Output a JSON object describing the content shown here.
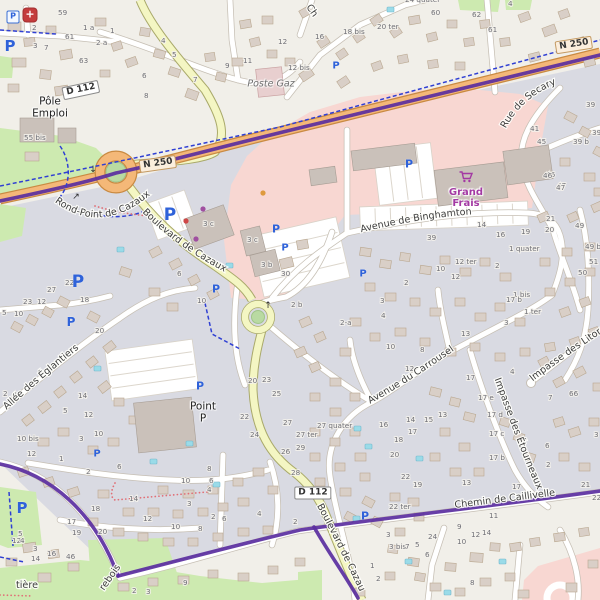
{
  "palette": {
    "land": "#f1efe9",
    "residential": "#d9dae2",
    "retail": "#f8d7d2",
    "green": "#cdeab0",
    "island_green": "#b9daa2",
    "island_stroke": "#a0c489",
    "building": "#d9cfc7",
    "building_stroke": "#b9a78f",
    "commercial": "#cac1ba",
    "commercial_stroke": "#a79d94",
    "pool": "#9adbe8",
    "pool_stroke": "#74b8cc",
    "road_minor": "#ffffff",
    "road_minor_casing": "#c6bfb4",
    "road_secondary": "#f4f6c3",
    "road_secondary_casing": "#a9a96a",
    "road_trunk": "#f4b878",
    "road_trunk_casing": "#c98a42",
    "route_bicycle": "#5a2ea0",
    "cycleway": "#2f3fd3",
    "footpath": "#e06f76",
    "parking_blue": "#2f62d9",
    "poi_purple": "#a339a3",
    "poste_building": "#e8cfcf"
  },
  "shields": [
    {
      "text": "D 112",
      "x": 81,
      "y": 90,
      "rot": -12,
      "cls": "d"
    },
    {
      "text": "N 250",
      "x": 158,
      "y": 164,
      "rot": -8,
      "cls": "n"
    },
    {
      "text": "N 250",
      "x": 574,
      "y": 45,
      "rot": -9,
      "cls": "n"
    },
    {
      "text": "D 112",
      "x": 313,
      "y": 493,
      "rot": 0,
      "cls": "d"
    }
  ],
  "street_labels": [
    {
      "id": "rond-point",
      "text": "Rond-Point de Cazaux",
      "mode": "path",
      "path": "tp-rond",
      "size": 9.3,
      "offset": "2%"
    },
    {
      "id": "bd-cazaux-upper",
      "text": "Boulevard de Cazaux",
      "mode": "path",
      "path": "tp-bd",
      "size": 9.8,
      "offset": "6%"
    },
    {
      "id": "binghamton",
      "text": "Avenue de Binghamton",
      "mode": "path",
      "path": "tp-bing",
      "size": 9.8,
      "offset": "4%"
    },
    {
      "id": "secary",
      "text": "Rue de Secary",
      "mode": "path",
      "path": "tp-sec",
      "size": 9.8,
      "offset": "2%"
    },
    {
      "id": "carrousel",
      "text": "Avenue du Carrousel",
      "mode": "path",
      "path": "tp-carr",
      "size": 9.8,
      "offset": "5%"
    },
    {
      "id": "etourneaux",
      "text": "Impasse des Étourneaux",
      "mode": "path",
      "path": "tp-etour",
      "size": 9.2,
      "offset": "1%"
    },
    {
      "id": "eglantiers",
      "text": "Allée des Églantiers",
      "mode": "path",
      "path": "tp-egl",
      "size": 9.8,
      "offset": "4%"
    },
    {
      "id": "litornes",
      "text": "Impasse des Litornes",
      "mode": "path",
      "path": "tp-lit",
      "size": 9.2,
      "offset": "1%"
    },
    {
      "id": "chemin-caillivelle",
      "text": "Chemin de Caillivelle",
      "mode": "path",
      "path": "tp-chem",
      "size": 9.2,
      "offset": "52%"
    },
    {
      "id": "bd-cazaux-lower",
      "text": "Boulevard de Cazaux",
      "mode": "path",
      "path": "tp-bdlow",
      "size": 9.2,
      "offset": "2%"
    },
    {
      "id": "fragment-ch",
      "text": "Ch",
      "mode": "rot",
      "x": 306,
      "y": 7,
      "rot": 55,
      "size": 9.5
    },
    {
      "id": "fragment-tiere",
      "text": "tière",
      "mode": "rot",
      "x": 16,
      "y": 588,
      "rot": 0,
      "size": 9.8
    },
    {
      "id": "fragment-rebois",
      "text": "rebois",
      "mode": "rot",
      "x": 104,
      "y": 591,
      "rot": -55,
      "size": 9.5
    }
  ],
  "places": {
    "pole_emploi": {
      "line1": "Pôle",
      "line2": "Emploi"
    },
    "poste_gaz": {
      "text": "Poste Gaz"
    },
    "point_p": {
      "line1": "Point",
      "line2": "P"
    },
    "grand_frais": {
      "line1": "Grand",
      "line2": "Frais"
    }
  },
  "icons": {
    "medical": "+",
    "parking_letter": "P"
  },
  "house_numbers": [
    [
      58,
      15,
      "59"
    ],
    [
      65,
      39,
      "61"
    ],
    [
      79,
      63,
      "63"
    ],
    [
      32,
      30,
      "2"
    ],
    [
      33,
      48,
      "3"
    ],
    [
      44,
      50,
      "7"
    ],
    [
      83,
      30,
      "1 a"
    ],
    [
      96,
      45,
      "2 a"
    ],
    [
      110,
      33,
      "1"
    ],
    [
      161,
      43,
      "4"
    ],
    [
      172,
      57,
      "5"
    ],
    [
      193,
      82,
      "7"
    ],
    [
      225,
      68,
      "9"
    ],
    [
      243,
      63,
      "11"
    ],
    [
      278,
      44,
      "12"
    ],
    [
      288,
      70,
      "12 bis"
    ],
    [
      142,
      78,
      "6"
    ],
    [
      144,
      98,
      "8"
    ],
    [
      24,
      140,
      "55 bis"
    ],
    [
      405,
      2,
      "24 quater"
    ],
    [
      431,
      15,
      "60"
    ],
    [
      472,
      17,
      "62"
    ],
    [
      488,
      32,
      "61"
    ],
    [
      377,
      29,
      "20 ter"
    ],
    [
      343,
      34,
      "18 bis"
    ],
    [
      315,
      39,
      "16"
    ],
    [
      508,
      6,
      "4"
    ],
    [
      586,
      107,
      "39"
    ],
    [
      530,
      131,
      "41"
    ],
    [
      537,
      144,
      "45"
    ],
    [
      573,
      144,
      "39 b"
    ],
    [
      592,
      135,
      "39 a"
    ],
    [
      546,
      177,
      "46"
    ],
    [
      557,
      188,
      "47"
    ],
    [
      203,
      226,
      "3 c"
    ],
    [
      247,
      242,
      "3 c"
    ],
    [
      261,
      267,
      "3 b"
    ],
    [
      281,
      276,
      "30"
    ],
    [
      291,
      307,
      "2 b"
    ],
    [
      177,
      276,
      "6"
    ],
    [
      197,
      303,
      "10"
    ],
    [
      65,
      285,
      "22"
    ],
    [
      47,
      292,
      "27"
    ],
    [
      23,
      304,
      "23"
    ],
    [
      37,
      304,
      "12"
    ],
    [
      80,
      302,
      "18"
    ],
    [
      2,
      315,
      "5"
    ],
    [
      14,
      316,
      "10"
    ],
    [
      95,
      333,
      "20"
    ],
    [
      78,
      398,
      "14"
    ],
    [
      63,
      413,
      "5"
    ],
    [
      84,
      417,
      "12"
    ],
    [
      94,
      436,
      "10"
    ],
    [
      79,
      441,
      "3"
    ],
    [
      17,
      441,
      "10 bis"
    ],
    [
      3,
      396,
      "2"
    ],
    [
      12,
      397,
      "4"
    ],
    [
      477,
      227,
      "14"
    ],
    [
      496,
      237,
      "16"
    ],
    [
      427,
      240,
      "39"
    ],
    [
      509,
      251,
      "1 quater"
    ],
    [
      495,
      268,
      "2"
    ],
    [
      436,
      271,
      "10"
    ],
    [
      455,
      264,
      "12 ter"
    ],
    [
      451,
      279,
      "12"
    ],
    [
      404,
      285,
      "2"
    ],
    [
      380,
      303,
      "3"
    ],
    [
      381,
      318,
      "4"
    ],
    [
      340,
      325,
      "2-a"
    ],
    [
      513,
      297,
      "1 bis"
    ],
    [
      524,
      314,
      "1 ter"
    ],
    [
      521,
      234,
      "19"
    ],
    [
      545,
      232,
      "20"
    ],
    [
      546,
      221,
      "21"
    ],
    [
      543,
      178,
      "46"
    ],
    [
      556,
      190,
      "47"
    ],
    [
      575,
      228,
      "49"
    ],
    [
      585,
      249,
      "49 bis"
    ],
    [
      589,
      264,
      "51"
    ],
    [
      578,
      275,
      "50"
    ],
    [
      504,
      325,
      "3"
    ],
    [
      510,
      374,
      "4"
    ],
    [
      466,
      380,
      "17"
    ],
    [
      478,
      400,
      "17 e"
    ],
    [
      487,
      417,
      "17 d"
    ],
    [
      489,
      436,
      "17 c"
    ],
    [
      506,
      302,
      "17 b"
    ],
    [
      489,
      460,
      "17 b"
    ],
    [
      569,
      396,
      "66"
    ],
    [
      548,
      400,
      "7"
    ],
    [
      594,
      437,
      "3"
    ],
    [
      545,
      448,
      "6"
    ],
    [
      546,
      467,
      "2"
    ],
    [
      461,
      336,
      "13"
    ],
    [
      386,
      349,
      "10"
    ],
    [
      420,
      352,
      "8"
    ],
    [
      405,
      371,
      "12"
    ],
    [
      406,
      422,
      "14"
    ],
    [
      424,
      422,
      "15"
    ],
    [
      438,
      417,
      "13"
    ],
    [
      379,
      427,
      "16"
    ],
    [
      408,
      434,
      "17"
    ],
    [
      394,
      442,
      "18"
    ],
    [
      390,
      457,
      "20"
    ],
    [
      401,
      479,
      "22"
    ],
    [
      413,
      487,
      "19"
    ],
    [
      248,
      383,
      "20"
    ],
    [
      262,
      382,
      "23"
    ],
    [
      272,
      396,
      "25"
    ],
    [
      283,
      425,
      "27"
    ],
    [
      317,
      428,
      "27 quater"
    ],
    [
      296,
      437,
      "27 ter"
    ],
    [
      240,
      419,
      "22"
    ],
    [
      250,
      437,
      "24"
    ],
    [
      281,
      454,
      "26"
    ],
    [
      296,
      450,
      "29"
    ],
    [
      291,
      475,
      "28"
    ],
    [
      27,
      456,
      "12"
    ],
    [
      59,
      461,
      "1"
    ],
    [
      86,
      474,
      "2"
    ],
    [
      117,
      469,
      "6"
    ],
    [
      129,
      501,
      "14"
    ],
    [
      91,
      511,
      "18"
    ],
    [
      67,
      524,
      "17"
    ],
    [
      72,
      535,
      "19"
    ],
    [
      98,
      534,
      "20"
    ],
    [
      143,
      521,
      "12"
    ],
    [
      181,
      483,
      "10"
    ],
    [
      207,
      471,
      "8"
    ],
    [
      171,
      529,
      "10"
    ],
    [
      187,
      506,
      "3"
    ],
    [
      198,
      531,
      "8"
    ],
    [
      211,
      519,
      "2"
    ],
    [
      222,
      521,
      "6"
    ],
    [
      209,
      483,
      "6"
    ],
    [
      207,
      492,
      "4"
    ],
    [
      257,
      516,
      "4"
    ],
    [
      293,
      524,
      "2"
    ],
    [
      18,
      536,
      "5"
    ],
    [
      12,
      543,
      "12"
    ],
    [
      20,
      543,
      "4"
    ],
    [
      33,
      551,
      "3"
    ],
    [
      31,
      561,
      "14"
    ],
    [
      47,
      556,
      "16"
    ],
    [
      66,
      559,
      "46"
    ],
    [
      183,
      585,
      "9"
    ],
    [
      146,
      594,
      "3"
    ],
    [
      132,
      593,
      "2"
    ],
    [
      389,
      509,
      "22 ter"
    ],
    [
      386,
      537,
      "3"
    ],
    [
      389,
      549,
      "3 bis"
    ],
    [
      405,
      549,
      "7"
    ],
    [
      415,
      547,
      "5"
    ],
    [
      428,
      539,
      "24"
    ],
    [
      425,
      557,
      "6"
    ],
    [
      457,
      529,
      "9"
    ],
    [
      489,
      518,
      "11"
    ],
    [
      457,
      544,
      "10"
    ],
    [
      471,
      537,
      "12"
    ],
    [
      482,
      535,
      "14"
    ],
    [
      376,
      581,
      "2"
    ],
    [
      370,
      568,
      "1"
    ],
    [
      470,
      585,
      "8"
    ],
    [
      462,
      485,
      "13"
    ],
    [
      512,
      489,
      "17"
    ],
    [
      535,
      497,
      "15"
    ],
    [
      581,
      487,
      "21"
    ],
    [
      592,
      500,
      "22"
    ]
  ],
  "parking_boxed": {
    "x": 13,
    "y": 17
  },
  "parking_icons": [
    [
      10,
      46,
      15
    ],
    [
      336,
      66,
      10
    ],
    [
      409,
      164,
      11
    ],
    [
      363,
      274,
      10
    ],
    [
      170,
      215,
      17
    ],
    [
      78,
      282,
      17
    ],
    [
      200,
      386,
      11
    ],
    [
      216,
      289,
      11
    ],
    [
      276,
      229,
      11
    ],
    [
      285,
      248,
      10
    ],
    [
      71,
      322,
      12
    ],
    [
      97,
      454,
      10
    ],
    [
      22,
      508,
      15
    ],
    [
      365,
      516,
      11
    ]
  ],
  "poi_dots": [
    [
      186,
      221,
      "#cf4646"
    ],
    [
      203,
      209,
      "#a04fa0"
    ],
    [
      196,
      239,
      "#a04fa0"
    ],
    [
      263,
      193,
      "#de9a3e"
    ]
  ],
  "arrows": [
    [
      93,
      170,
      "↓"
    ],
    [
      76,
      197,
      "↗"
    ],
    [
      268,
      306,
      "↑"
    ]
  ]
}
